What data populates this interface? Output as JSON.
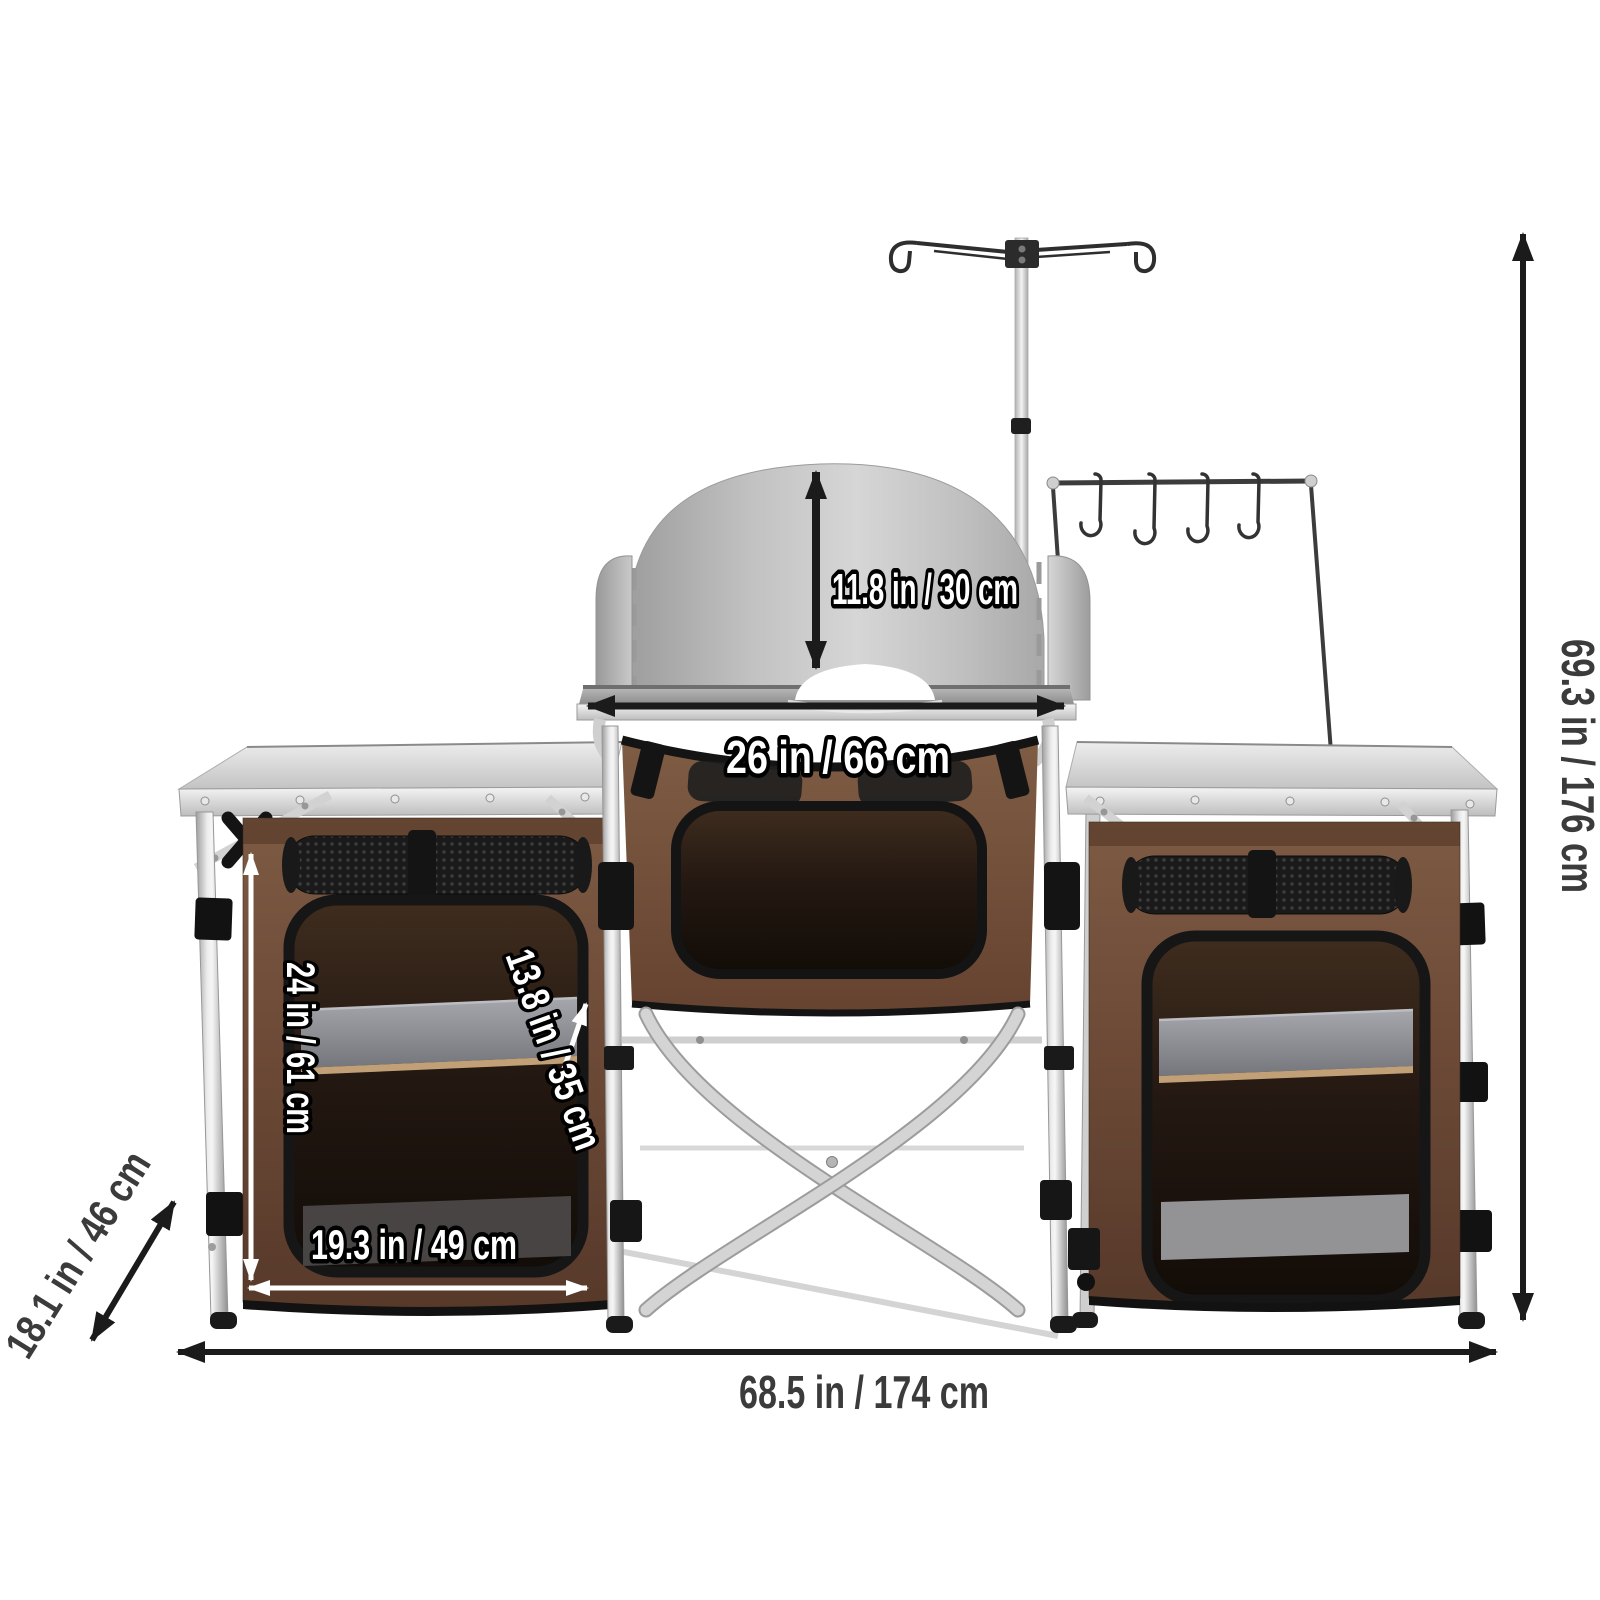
{
  "dimension_labels": {
    "windscreen_height": "11.8 in / 30 cm",
    "burner_table_width": "26 in / 66 cm",
    "overall_height": "69.3 in / 176 cm",
    "overall_width": "68.5 in / 174 cm",
    "overall_depth": "18.1 in / 46 cm",
    "cupboard_height": "24 in / 61 cm",
    "cupboard_diagonal": "13.8 in / 35 cm",
    "cupboard_width": "19.3 in / 49 cm"
  },
  "colors": {
    "background": "#ffffff",
    "dimension_line_dark": "#1b1b1b",
    "dimension_text_dark": "#3b3b3b",
    "dimension_text_light": "#ffffff",
    "fabric_brown": "#6b4936",
    "fabric_brown_dark": "#57392a",
    "trim_black": "#141414",
    "metal_silver": "#d4d4d4",
    "windscreen_gray": "#c4c4c4",
    "shelf_gray": "#8f9096",
    "interior_dark": "#17100a"
  }
}
